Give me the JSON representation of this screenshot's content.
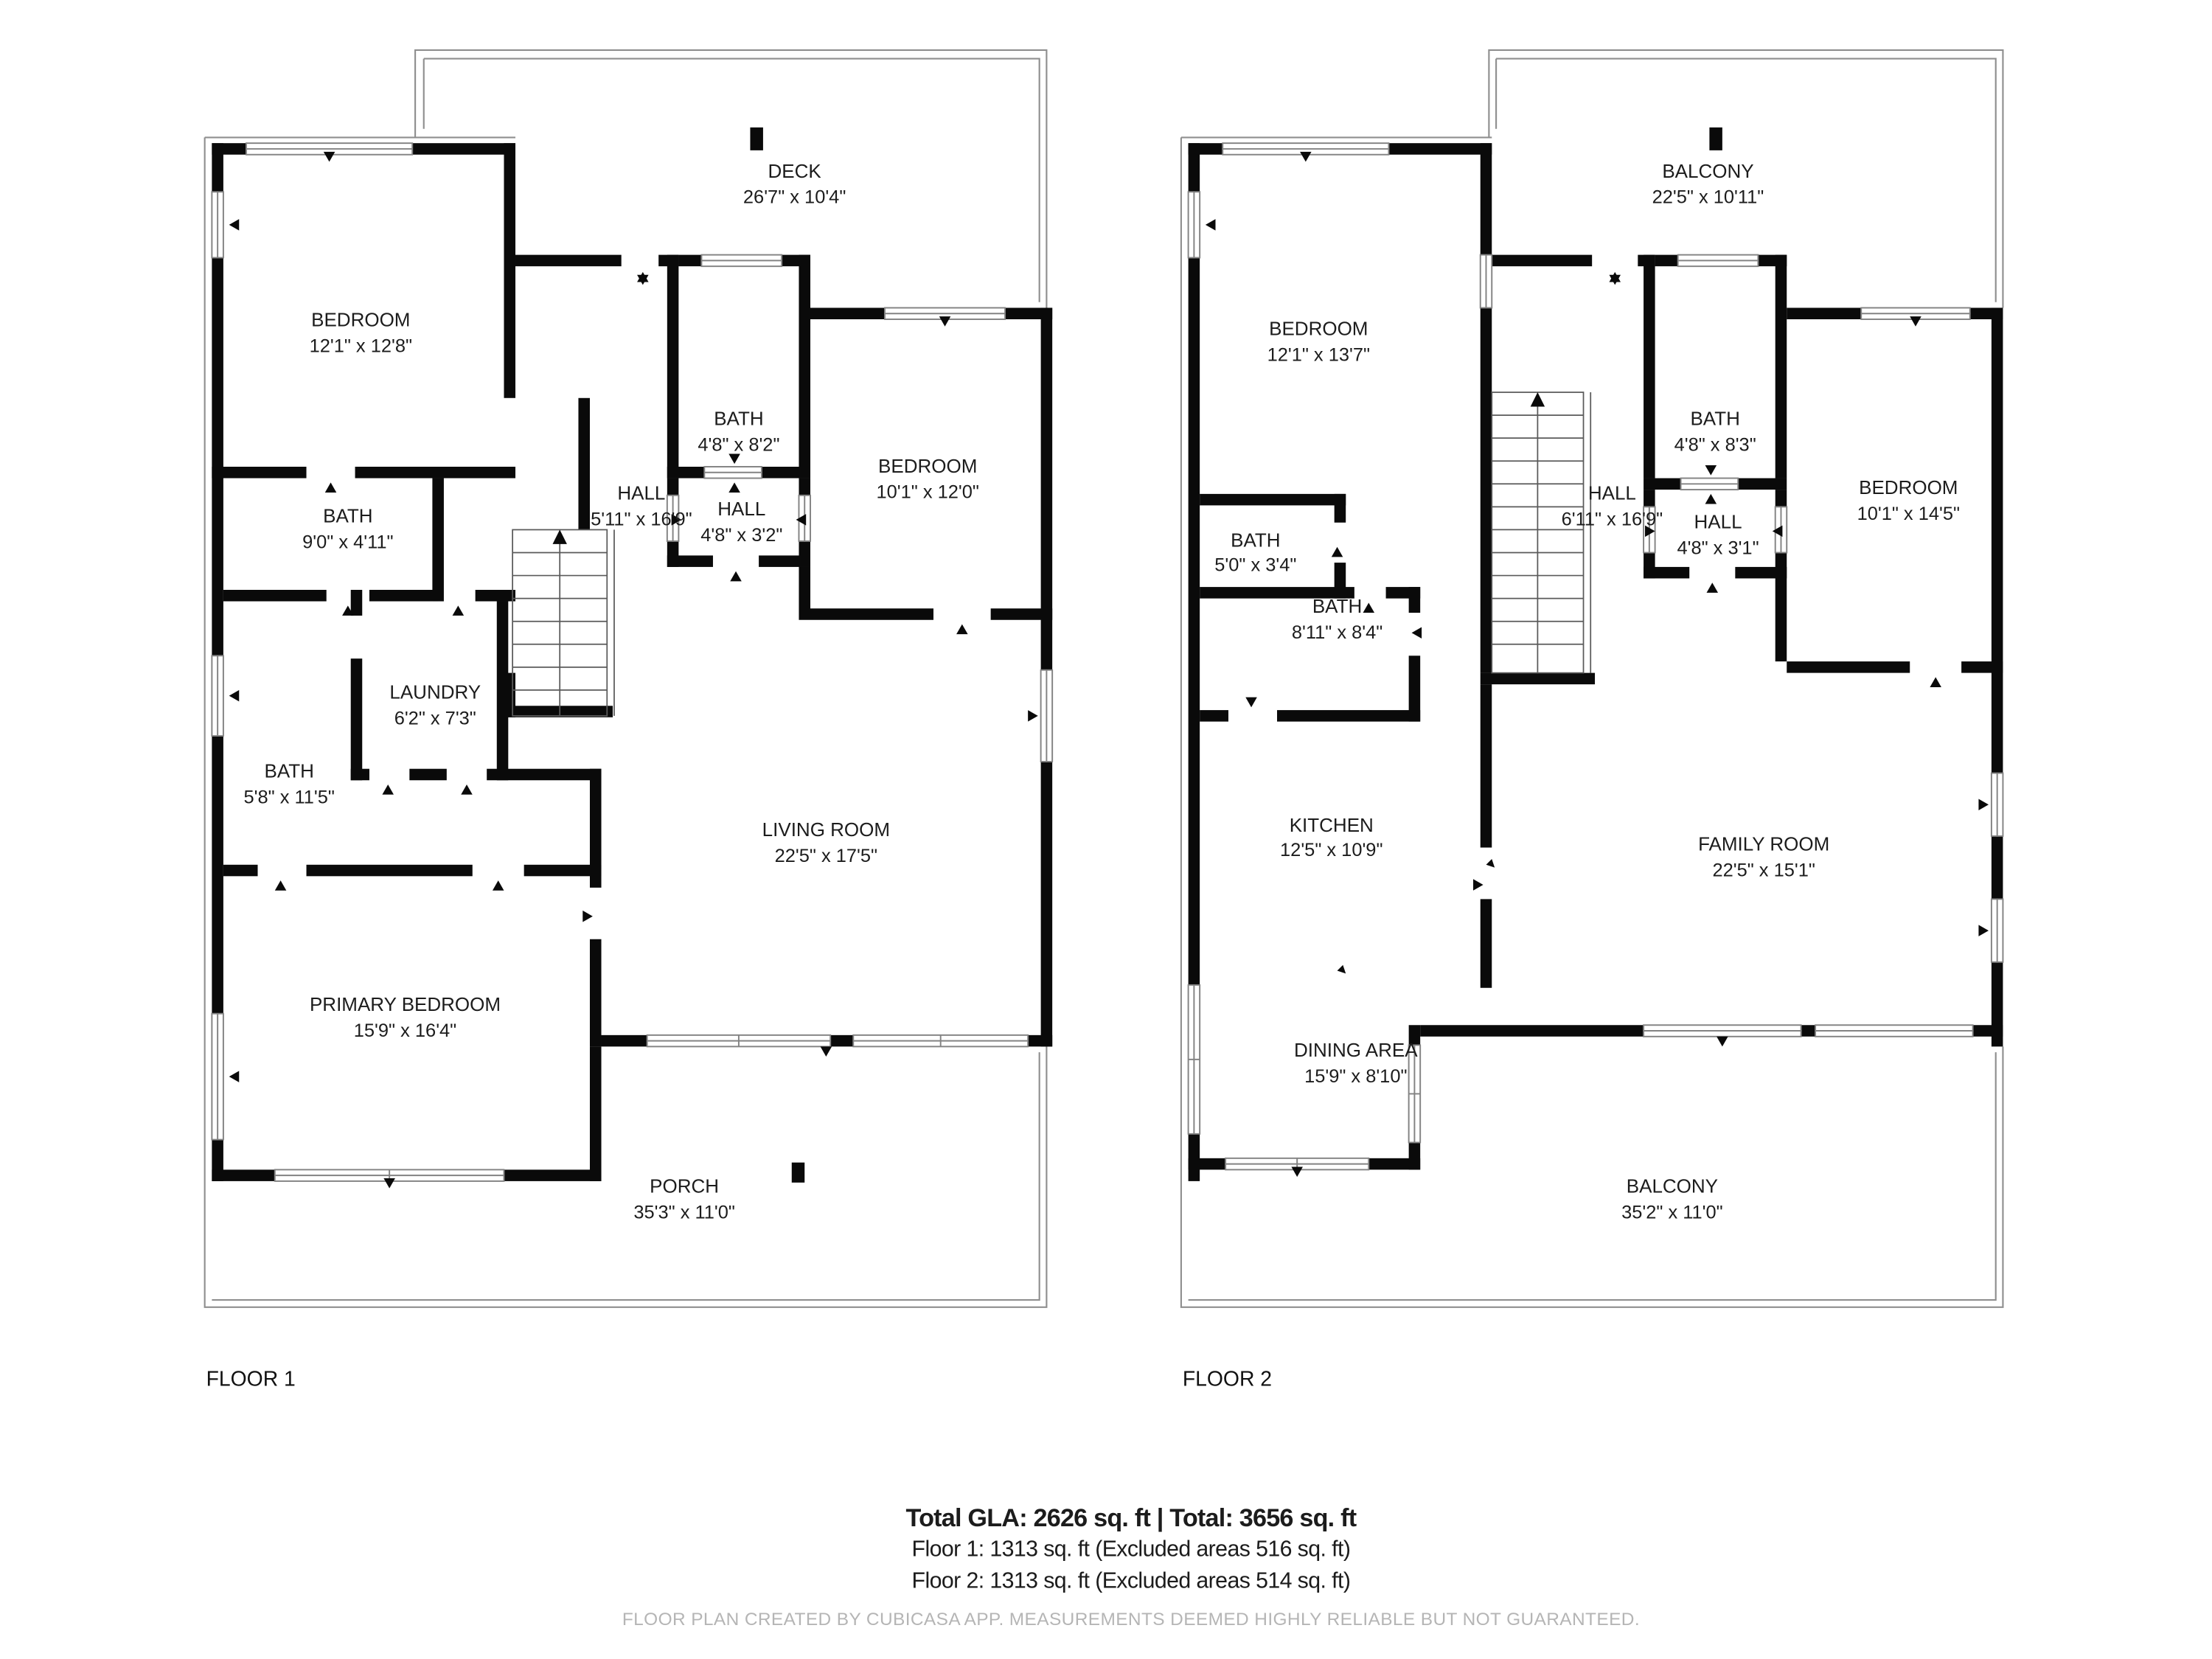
{
  "floor1": {
    "label": "FLOOR 1",
    "rooms": {
      "deck": {
        "name": "DECK",
        "dims": "26'7\" x 10'4\""
      },
      "bedroom1": {
        "name": "BEDROOM",
        "dims": "12'1\" x 12'8\""
      },
      "bath9": {
        "name": "BATH",
        "dims": "9'0\" x 4'11\""
      },
      "bath48": {
        "name": "BATH",
        "dims": "4'8\" x 8'2\""
      },
      "hall_main": {
        "name": "HALL",
        "dims": "5'11\" x 16'9\""
      },
      "hall_sm": {
        "name": "HALL",
        "dims": "4'8\" x 3'2\""
      },
      "bedroom2": {
        "name": "BEDROOM",
        "dims": "10'1\" x 12'0\""
      },
      "laundry": {
        "name": "LAUNDRY",
        "dims": "6'2\" x 7'3\""
      },
      "bath58": {
        "name": "BATH",
        "dims": "5'8\" x 11'5\""
      },
      "living": {
        "name": "LIVING ROOM",
        "dims": "22'5\" x 17'5\""
      },
      "primary": {
        "name": "PRIMARY BEDROOM",
        "dims": "15'9\" x 16'4\""
      },
      "porch": {
        "name": "PORCH",
        "dims": "35'3\" x 11'0\""
      }
    }
  },
  "floor2": {
    "label": "FLOOR 2",
    "rooms": {
      "balcony_top": {
        "name": "BALCONY",
        "dims": "22'5\" x 10'11\""
      },
      "bedroom1": {
        "name": "BEDROOM",
        "dims": "12'1\" x 13'7\""
      },
      "bath48": {
        "name": "BATH",
        "dims": "4'8\" x 8'3\""
      },
      "hall_main": {
        "name": "HALL",
        "dims": "6'11\" x 16'9\""
      },
      "hall_sm": {
        "name": "HALL",
        "dims": "4'8\" x 3'1\""
      },
      "bath50": {
        "name": "BATH",
        "dims": "5'0\" x 3'4\""
      },
      "bath811": {
        "name": "BATH",
        "dims": "8'11\" x 8'4\""
      },
      "bedroom2": {
        "name": "BEDROOM",
        "dims": "10'1\" x 14'5\""
      },
      "kitchen": {
        "name": "KITCHEN",
        "dims": "12'5\" x 10'9\""
      },
      "family": {
        "name": "FAMILY ROOM",
        "dims": "22'5\" x 15'1\""
      },
      "dining": {
        "name": "DINING AREA",
        "dims": "15'9\" x 8'10\""
      },
      "balcony_bot": {
        "name": "BALCONY",
        "dims": "35'2\" x 11'0\""
      }
    }
  },
  "summary": {
    "total_line": "Total GLA: 2626 sq. ft | Total: 3656 sq. ft",
    "floor1_line": "Floor 1: 1313 sq. ft (Excluded areas 516 sq. ft)",
    "floor2_line": "Floor 2: 1313 sq. ft (Excluded areas 514 sq. ft)"
  },
  "footer": "FLOOR PLAN CREATED BY CUBICASA APP. MEASUREMENTS DEEMED HIGHLY RELIABLE BUT NOT GUARANTEED.",
  "colors": {
    "wall": "#0a0a0a",
    "outline": "#8f8f8f",
    "text": "#1c1c1c",
    "muted": "#b5b5b5"
  }
}
